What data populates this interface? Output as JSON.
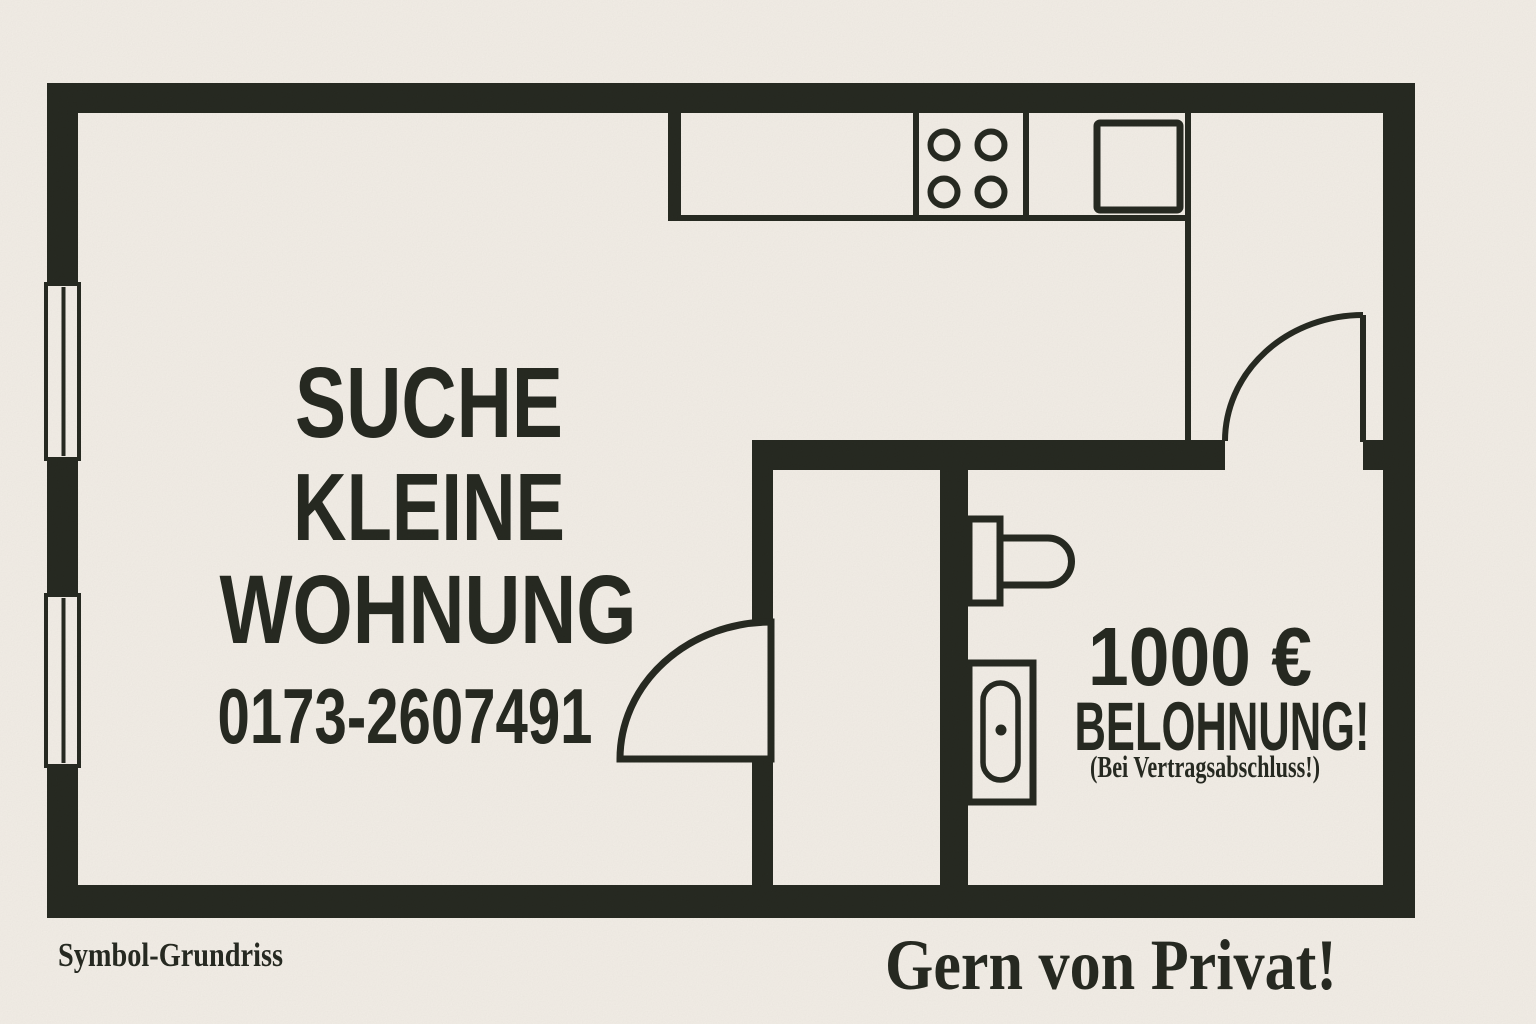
{
  "poster": {
    "headline": {
      "line1": "SUCHE",
      "line2": "KLEINE",
      "line3": "WOHNUNG"
    },
    "phone": "0173-2607491",
    "reward": {
      "amount": "1000 €",
      "label": "BELOHNUNG!",
      "condition": "(Bei Vertragsabschluss!)"
    },
    "footnote": "Symbol-Grundriss",
    "tagline": "Gern von Privat!"
  },
  "colors": {
    "background": "#f5f0e9",
    "ink": "#24271f"
  },
  "floorplan": {
    "icons": [
      "window-icon",
      "stove-burners-icon",
      "kitchen-sink-icon",
      "door-swing-icon",
      "toilet-icon",
      "bathtub-icon"
    ]
  }
}
